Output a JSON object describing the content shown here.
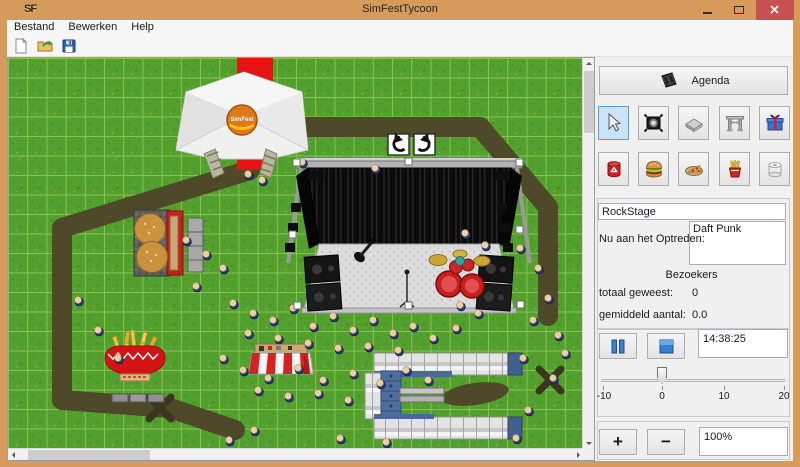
{
  "window": {
    "title": "SimFestTycoon",
    "icon_text": "SF"
  },
  "menu": {
    "items": [
      "Bestand",
      "Bewerken",
      "Help"
    ]
  },
  "toolbar": {
    "buttons": [
      "new-file",
      "open-file",
      "save-file"
    ]
  },
  "map": {
    "tent_logo": "SimFest",
    "selected_object": "RockStage",
    "people": [
      [
        294,
        104
      ],
      [
        367,
        110
      ],
      [
        240,
        116
      ],
      [
        254,
        122
      ],
      [
        457,
        175
      ],
      [
        477,
        187
      ],
      [
        452,
        247
      ],
      [
        470,
        255
      ],
      [
        512,
        190
      ],
      [
        530,
        210
      ],
      [
        540,
        240
      ],
      [
        525,
        262
      ],
      [
        550,
        277
      ],
      [
        515,
        300
      ],
      [
        545,
        320
      ],
      [
        557,
        295
      ],
      [
        225,
        245
      ],
      [
        245,
        255
      ],
      [
        265,
        262
      ],
      [
        285,
        250
      ],
      [
        305,
        268
      ],
      [
        325,
        258
      ],
      [
        345,
        272
      ],
      [
        365,
        262
      ],
      [
        385,
        275
      ],
      [
        405,
        268
      ],
      [
        425,
        280
      ],
      [
        448,
        270
      ],
      [
        300,
        285
      ],
      [
        330,
        290
      ],
      [
        360,
        288
      ],
      [
        390,
        292
      ],
      [
        270,
        280
      ],
      [
        240,
        275
      ],
      [
        215,
        300
      ],
      [
        235,
        312
      ],
      [
        260,
        320
      ],
      [
        290,
        310
      ],
      [
        315,
        322
      ],
      [
        345,
        315
      ],
      [
        372,
        325
      ],
      [
        398,
        312
      ],
      [
        420,
        322
      ],
      [
        310,
        335
      ],
      [
        280,
        338
      ],
      [
        250,
        332
      ],
      [
        340,
        342
      ],
      [
        178,
        182
      ],
      [
        198,
        196
      ],
      [
        215,
        210
      ],
      [
        188,
        228
      ],
      [
        90,
        272
      ],
      [
        70,
        242
      ],
      [
        110,
        300
      ],
      [
        221,
        382
      ],
      [
        246,
        372
      ],
      [
        332,
        380
      ],
      [
        378,
        384
      ],
      [
        508,
        380
      ],
      [
        520,
        352
      ]
    ]
  },
  "sidebar": {
    "agenda_label": "Agenda",
    "tools_row1": [
      "select-tool",
      "spotlight",
      "paving",
      "entrance-gate",
      "gift"
    ],
    "tools_row2": [
      "trash-bin",
      "hamburger",
      "pizza",
      "fries",
      "toilet-roll"
    ],
    "stage_name": "RockStage",
    "now_performing_label": "Nu aan het Optreden:",
    "now_performing": "Daft Punk",
    "visitors_header": "Bezoekers",
    "total_label": "totaal geweest:",
    "total_value": "0",
    "average_label": "gemiddeld aantal:",
    "average_value": "0.0",
    "time": "14:38:25",
    "slider": {
      "min": -10,
      "max": 20,
      "value": 0,
      "ticks": [
        "-10",
        "0",
        "10",
        "20"
      ]
    },
    "plus_label": "+",
    "minus_label": "−",
    "zoom_value": "100%"
  },
  "colors": {
    "titlebar": "#D69B5B",
    "close_button": "#C75050",
    "grass": "#54A02E",
    "path": "#4E4929",
    "selection_highlight": "#CBE3F6"
  }
}
